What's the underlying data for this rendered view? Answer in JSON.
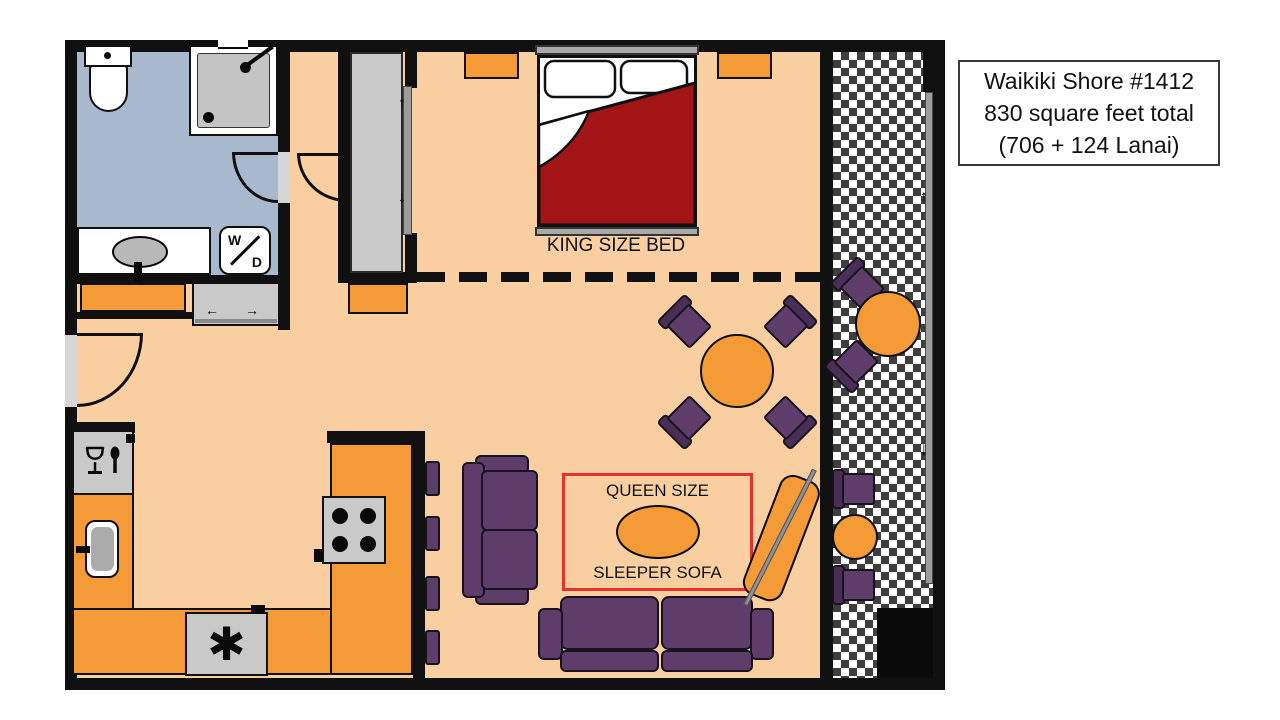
{
  "title_box": {
    "line1": "Waikiki Shore #1412",
    "line2": "830 square feet total",
    "line3": "(706 + 124 Lanai)"
  },
  "bedroom": {
    "bed_label": "KING SIZE BED"
  },
  "living_room": {
    "sleeper_marker": {
      "line_top": "QUEEN SIZE",
      "line_bottom": "SLEEPER SOFA"
    }
  },
  "bathroom": {
    "washer_dryer": {
      "letter_top": "W",
      "letter_bottom": "D"
    }
  },
  "icons": {
    "asterisk": "✱",
    "slide_left_arrow": "←",
    "slide_right_arrow": "→",
    "slide_up_arrow": "↑",
    "slide_down_arrow": "↓",
    "glassware": "wine-glass-and-spoon-icon",
    "shower": "shower-head-icon"
  },
  "colors": {
    "wall": "#101010",
    "floor_peach": "#F9CFA1",
    "orange": "#F49B38",
    "purple": "#5E3D6B",
    "purple_dark": "#4B2E57",
    "bed_red": "#A31416",
    "marker_red": "#E5302B",
    "bathroom_blue": "#A8B9CE",
    "appliance_gray": "#C9C9C9",
    "checker_dark": "#3E3E3E"
  }
}
